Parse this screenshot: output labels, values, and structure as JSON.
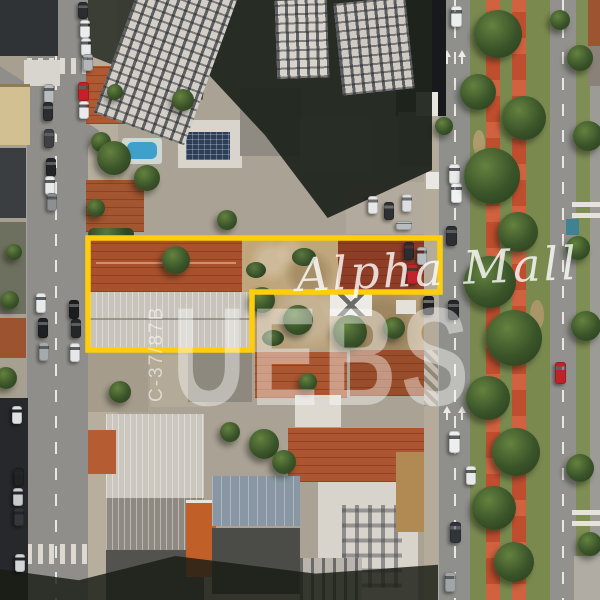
{
  "image": {
    "kind": "aerial-drone-photo",
    "description": "Top-down aerial photo of an urban block with terracotta roofs, a tree-lined avenue with red bike paths on the median, parked cars, and a property boundary highlighted in yellow",
    "width": 600,
    "height": 600
  },
  "watermarks": {
    "brand_script": {
      "text": "Alpha Mall",
      "color": "#FFFFFF",
      "opacity": 0.8
    },
    "brand_large": {
      "text": "UEBS",
      "color": "#FFFFFF",
      "opacity": 0.42
    },
    "lot_code": {
      "text": "C-37/87B",
      "color": "#FFFFFF",
      "opacity": 0.55
    }
  },
  "overlay": {
    "property_outline": {
      "color": "#FFCE0A",
      "stroke_width": 5.5,
      "points": "88,238 440,238 440,292 252,292 252,350 88,350"
    }
  },
  "palette": {
    "outline_yellow": "#FFCE0A",
    "bike_path_red": "#BF4E2E",
    "median_grass": "#7A8A4F",
    "asphalt": "#8F8E8A",
    "sidewalk": "#B7AE9E",
    "terracotta_roof": "#A8512C",
    "dark_red_roof": "#8E3D26",
    "warehouse_roof": "#C8C4BB",
    "metal_blue_roof": "#8897A3",
    "shadow": "#1F241D",
    "pool_blue": "#3FA0CB",
    "red_car": "#C3242B"
  },
  "scene": {
    "trees": [
      {
        "x": 498,
        "y": 34,
        "r": 24
      },
      {
        "x": 478,
        "y": 92,
        "r": 18
      },
      {
        "x": 524,
        "y": 118,
        "r": 22
      },
      {
        "x": 492,
        "y": 176,
        "r": 28
      },
      {
        "x": 518,
        "y": 232,
        "r": 20
      },
      {
        "x": 490,
        "y": 282,
        "r": 26
      },
      {
        "x": 514,
        "y": 338,
        "r": 28
      },
      {
        "x": 488,
        "y": 398,
        "r": 22
      },
      {
        "x": 516,
        "y": 452,
        "r": 24
      },
      {
        "x": 494,
        "y": 508,
        "r": 22
      },
      {
        "x": 514,
        "y": 562,
        "r": 20
      },
      {
        "x": 560,
        "y": 20,
        "r": 10
      },
      {
        "x": 580,
        "y": 58,
        "r": 13
      },
      {
        "x": 588,
        "y": 136,
        "r": 15
      },
      {
        "x": 578,
        "y": 248,
        "r": 12
      },
      {
        "x": 586,
        "y": 326,
        "r": 15
      },
      {
        "x": 580,
        "y": 468,
        "r": 14
      },
      {
        "x": 590,
        "y": 544,
        "r": 12
      },
      {
        "x": 101,
        "y": 142,
        "r": 10
      },
      {
        "x": 96,
        "y": 208,
        "r": 9
      },
      {
        "x": 115,
        "y": 92,
        "r": 8
      },
      {
        "x": 114,
        "y": 158,
        "r": 17
      },
      {
        "x": 147,
        "y": 178,
        "r": 13
      },
      {
        "x": 183,
        "y": 100,
        "r": 11
      },
      {
        "x": 227,
        "y": 220,
        "r": 10
      },
      {
        "x": 176,
        "y": 260,
        "r": 14
      },
      {
        "x": 262,
        "y": 300,
        "r": 13
      },
      {
        "x": 298,
        "y": 320,
        "r": 15
      },
      {
        "x": 350,
        "y": 332,
        "r": 17
      },
      {
        "x": 394,
        "y": 328,
        "r": 11
      },
      {
        "x": 120,
        "y": 392,
        "r": 11
      },
      {
        "x": 264,
        "y": 444,
        "r": 15
      },
      {
        "x": 284,
        "y": 462,
        "r": 12
      },
      {
        "x": 230,
        "y": 432,
        "r": 10
      },
      {
        "x": 308,
        "y": 382,
        "r": 9
      },
      {
        "x": 444,
        "y": 126,
        "r": 9
      },
      {
        "x": 10,
        "y": 300,
        "r": 9
      },
      {
        "x": 6,
        "y": 378,
        "r": 11
      },
      {
        "x": 14,
        "y": 252,
        "r": 8
      }
    ],
    "cars": [
      {
        "x": 44,
        "y": 84,
        "w": 10,
        "h": 19,
        "color": "#b9bcbe"
      },
      {
        "x": 43,
        "y": 102,
        "w": 10,
        "h": 19,
        "color": "#2b2d30"
      },
      {
        "x": 44,
        "y": 129,
        "w": 10,
        "h": 19,
        "color": "#3e4043"
      },
      {
        "x": 46,
        "y": 158,
        "w": 10,
        "h": 19,
        "color": "#222426"
      },
      {
        "x": 45,
        "y": 176,
        "w": 10,
        "h": 19,
        "color": "#e8e8e8"
      },
      {
        "x": 47,
        "y": 193,
        "w": 10,
        "h": 18,
        "color": "#8d9093"
      },
      {
        "x": 36,
        "y": 293,
        "w": 10,
        "h": 20,
        "color": "#e8e9ea"
      },
      {
        "x": 38,
        "y": 318,
        "w": 10,
        "h": 20,
        "color": "#1e2023"
      },
      {
        "x": 39,
        "y": 342,
        "w": 10,
        "h": 19,
        "color": "#a6a9ac"
      },
      {
        "x": 78,
        "y": 2,
        "w": 10,
        "h": 17,
        "color": "#2a2c2f"
      },
      {
        "x": 80,
        "y": 20,
        "w": 10,
        "h": 18,
        "color": "#eceded"
      },
      {
        "x": 81,
        "y": 38,
        "w": 10,
        "h": 18,
        "color": "#e8e9ea"
      },
      {
        "x": 83,
        "y": 54,
        "w": 10,
        "h": 17,
        "color": "#b4b7ba"
      },
      {
        "x": 78,
        "y": 82,
        "w": 11,
        "h": 19,
        "color": "#c22127"
      },
      {
        "x": 79,
        "y": 101,
        "w": 10,
        "h": 18,
        "color": "#eaebec"
      },
      {
        "x": 69,
        "y": 300,
        "w": 10,
        "h": 19,
        "color": "#1b1d1f"
      },
      {
        "x": 71,
        "y": 319,
        "w": 10,
        "h": 19,
        "color": "#242628"
      },
      {
        "x": 70,
        "y": 343,
        "w": 10,
        "h": 19,
        "color": "#e6e7e8"
      },
      {
        "x": 12,
        "y": 406,
        "w": 10,
        "h": 18,
        "color": "#dfe0e1"
      },
      {
        "x": 14,
        "y": 468,
        "w": 10,
        "h": 18,
        "color": "#222222"
      },
      {
        "x": 13,
        "y": 488,
        "w": 10,
        "h": 18,
        "color": "#c8cacc"
      },
      {
        "x": 14,
        "y": 508,
        "w": 10,
        "h": 18,
        "color": "#35373a"
      },
      {
        "x": 15,
        "y": 554,
        "w": 10,
        "h": 18,
        "color": "#d4d5d6"
      },
      {
        "x": 368,
        "y": 196,
        "w": 10,
        "h": 18,
        "color": "#e6e7e8"
      },
      {
        "x": 384,
        "y": 202,
        "w": 10,
        "h": 18,
        "color": "#2e3033"
      },
      {
        "x": 402,
        "y": 194,
        "w": 10,
        "h": 18,
        "color": "#dcdee0"
      },
      {
        "x": 396,
        "y": 221,
        "w": 16,
        "h": 9,
        "color": "#b9bcbe"
      },
      {
        "x": 404,
        "y": 242,
        "w": 10,
        "h": 18,
        "color": "#2b2d30"
      },
      {
        "x": 417,
        "y": 247,
        "w": 10,
        "h": 18,
        "color": "#b9bcbf"
      },
      {
        "x": 407,
        "y": 264,
        "w": 11,
        "h": 20,
        "color": "#c3242b"
      },
      {
        "x": 423,
        "y": 296,
        "w": 11,
        "h": 19,
        "color": "#1d1f22"
      },
      {
        "x": 451,
        "y": 6,
        "w": 11,
        "h": 21,
        "color": "#eceded"
      },
      {
        "x": 449,
        "y": 164,
        "w": 11,
        "h": 20,
        "color": "#e9eaeb"
      },
      {
        "x": 451,
        "y": 183,
        "w": 11,
        "h": 20,
        "color": "#f0f1f1"
      },
      {
        "x": 446,
        "y": 226,
        "w": 11,
        "h": 20,
        "color": "#2d2f32"
      },
      {
        "x": 448,
        "y": 300,
        "w": 11,
        "h": 20,
        "color": "#232528"
      },
      {
        "x": 449,
        "y": 431,
        "w": 11,
        "h": 22,
        "color": "#edeeee"
      },
      {
        "x": 466,
        "y": 466,
        "w": 10,
        "h": 19,
        "color": "#e8e9ea"
      },
      {
        "x": 450,
        "y": 522,
        "w": 11,
        "h": 21,
        "color": "#31353b"
      },
      {
        "x": 445,
        "y": 572,
        "w": 11,
        "h": 20,
        "color": "#a2a5a8"
      },
      {
        "x": 555,
        "y": 362,
        "w": 11,
        "h": 22,
        "color": "#bf2329"
      },
      {
        "x": 590,
        "y": 126,
        "w": 9,
        "h": 18,
        "color": "#eceded"
      }
    ]
  }
}
